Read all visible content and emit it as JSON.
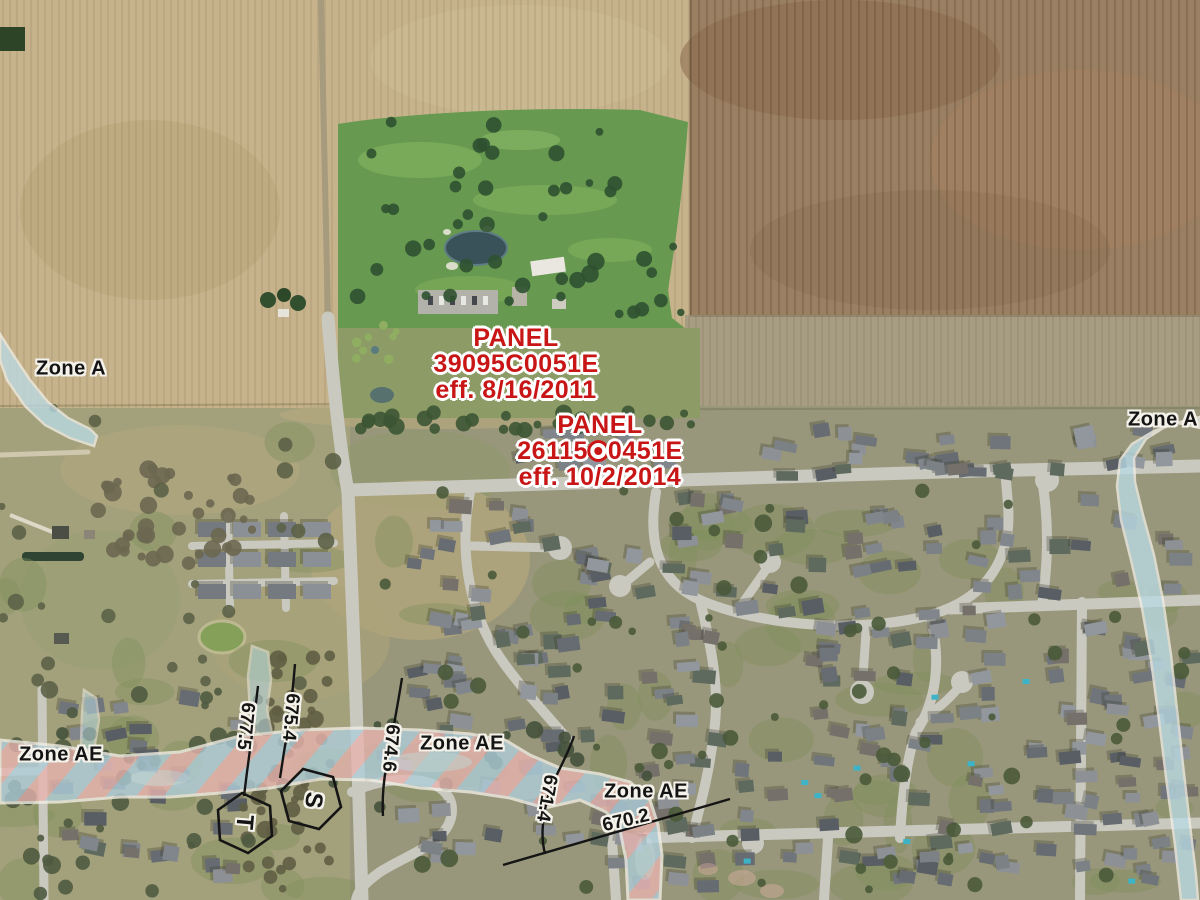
{
  "map": {
    "panels": [
      {
        "title": "PANEL",
        "number": "39095C0051E",
        "effective": "eff. 8/16/2011"
      },
      {
        "title": "PANEL",
        "number_prefix": "26115",
        "number_suffix": "0451E",
        "effective": "eff. 10/2/2014"
      }
    ],
    "zone_labels": [
      {
        "id": "zone-a-northwest",
        "text": "Zone A"
      },
      {
        "id": "zone-a-northeast",
        "text": "Zone A"
      },
      {
        "id": "zone-ae-west",
        "text": "Zone AE"
      },
      {
        "id": "zone-ae-center",
        "text": "Zone AE"
      },
      {
        "id": "zone-ae-south",
        "text": "Zone AE"
      }
    ],
    "bfe_labels": [
      {
        "value": "677.5"
      },
      {
        "value": "675.4"
      },
      {
        "value": "674.6"
      },
      {
        "value": "671.4"
      },
      {
        "value": "670.2"
      }
    ],
    "cross_sections": [
      {
        "letter": "S"
      },
      {
        "letter": "T"
      }
    ],
    "colors": {
      "panel_text": "#c81616",
      "zone_label_text": "#141414",
      "halo": "#f4f2ea",
      "zone_a_fill": "#badae4",
      "zone_ae_blue": "#afcfdc",
      "zone_ae_pink": "#e9b4b0"
    }
  }
}
